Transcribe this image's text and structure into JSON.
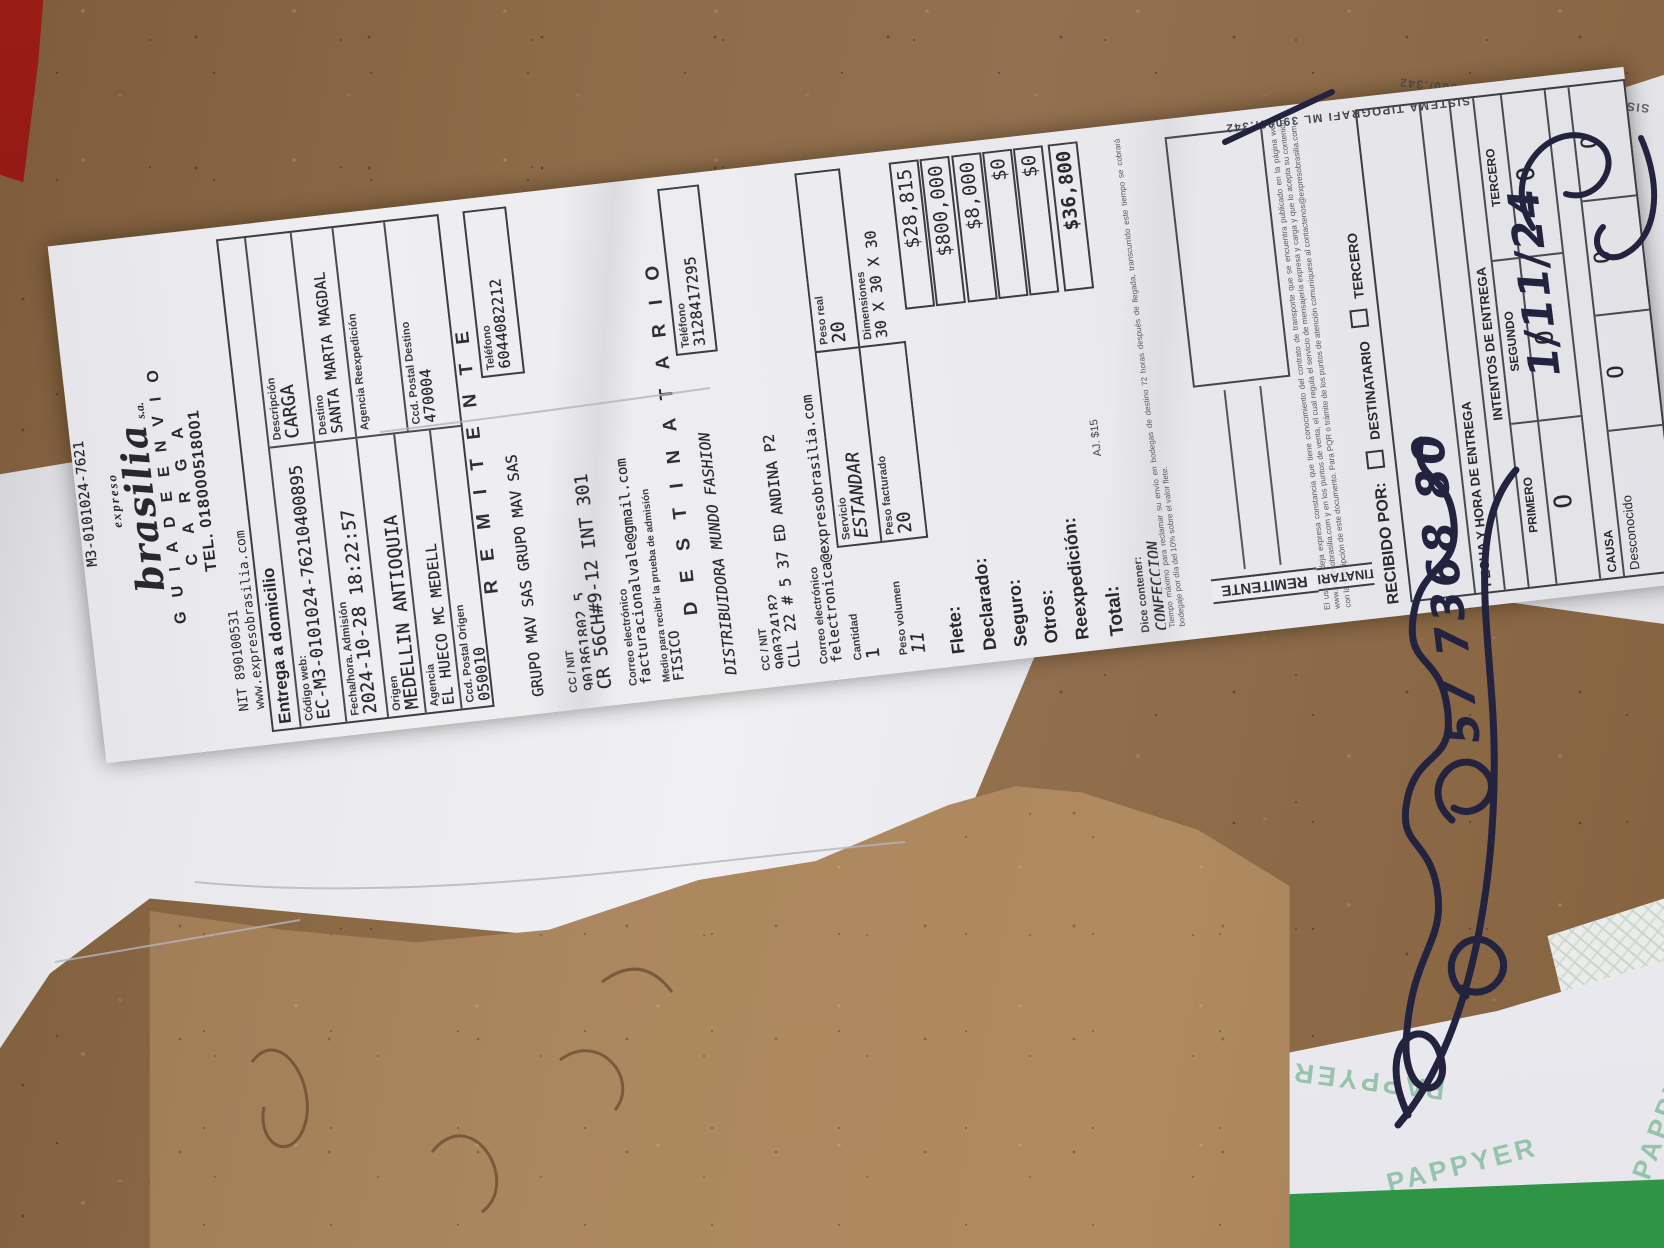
{
  "receipt": {
    "top_code": "M3-0101024-7621",
    "header": {
      "brand_top": "expreso",
      "brand_main": "brasilia",
      "brand_suffix": "s.a.",
      "title": "G U I A   D E   E N V I O",
      "subtitle": "C A R G A",
      "phone": "TEL. 018000518001",
      "nit": "NIT 890100531",
      "web": "www.expresobrasilia.com",
      "email": "contactenos@expresobrasilia.com",
      "resolution": "00159 del 30 de julio de 2.002"
    },
    "info": {
      "section_title": "Entrega a domicilio",
      "codigo_web_label": "Código web:",
      "codigo_web": "EC-M3-0101024-76210400895",
      "descripcion_label": "Descripción",
      "descripcion": "CARGA",
      "fecha_label": "Fecha/hora. Admisión",
      "fecha": "2024-10-28 18:22:57",
      "destino_label": "Destino",
      "destino": "SANTA MARTA MAGDAL",
      "origen_label": "Origen",
      "origen": "MEDELLIN ANTIOQUIA",
      "agencia_reexp_label": "Agencia Reexpedición",
      "agencia_label": "Agencia",
      "agencia": "EL HUECO MC MEDELL",
      "cp_destino_label": "Ccd. Postal Destino",
      "cp_destino": "470004",
      "cp_origen_label": "Ccd. Postal Origen",
      "cp_origen": "050010"
    },
    "remitente": {
      "title": "R E M I T E N T E",
      "nombre": "GRUPO MAV SAS GRUPO MAV SAS",
      "telefono_label": "Teléfono",
      "telefono": "6044082212",
      "ccnit_label": "CC / NIT",
      "ccnit": "901861802 5",
      "direccion": "CR 56CH#9-12 INT 301",
      "correo_label": "Correo electrónico",
      "correo": "facturacionalvale@gmail.com",
      "medio_label": "Medio para recibir la prueba de admisión",
      "medio": "FISICO"
    },
    "destinatario": {
      "title": "D E S T I N A T A R I O",
      "nombre": "DISTRIBUIDORA MUNDO FASHION",
      "telefono_label": "Teléfono",
      "telefono": "3128417295",
      "ccnit_label": "CC / NIT",
      "ccnit": "900324182",
      "direccion": "CLL 22 # 5 37 ED ANDINA P2",
      "correo_label": "Correo electrónico",
      "correo": "felectronica@expresobrasilia.com"
    },
    "cargo": {
      "cantidad_label": "Cantidad",
      "cantidad": "1",
      "servicio_label": "Servicio",
      "servicio": "ESTANDAR",
      "peso_real_label": "Peso real",
      "peso_real": "20",
      "peso_vol_label": "Peso volumen",
      "peso_vol": "11",
      "peso_fact_label": "Peso facturado",
      "peso_fact": "20",
      "dim_label": "Dimensiones",
      "dim": "30 X 30 X 30"
    },
    "totals": {
      "flete_label": "Flete:",
      "flete": "$28,815",
      "declarado_label": "Declarado:",
      "declarado": "$800,000",
      "seguro_label": "Seguro:",
      "seguro": "$8,000",
      "otros_label": "Otros:",
      "otros": "$0",
      "reexp_label": "Reexpedición:",
      "reexp": "$0",
      "total_label": "Total:",
      "total_note": "AJ. $15",
      "total": "$36,800",
      "dice_label": "Dice contener:",
      "dice": "CONFECCION"
    },
    "fine_print": {
      "p1": "Tiempo máximo para reclamar su envío en bodegas de destino 72 horas después de llegada, transcurrido este tiempo se cobrará bodegaje por día del 10% sobre el valor flete.",
      "p2": "El usuario deja expresa constancia que tiene conocimiento del contrato de transporte que se encuentra publicado en la página web www.expresobrasilia.com y en los puntos de venta, el cual regula el servicio de mensajería expresa y carga y que lo acepta su contenido con la suscripción de este documento. Para PQR o trámite de los puntos de atención comuníquese al contactenos@expresobrasilia.com"
    },
    "delivery": {
      "recibido_label": "RECIBIDO POR:",
      "opt_destinatario": "DESTINATARIO",
      "opt_tercero": "TERCERO",
      "fecha_label": "FECHA Y HORA DE ENTREGA",
      "intentos_label": "INTENTOS DE ENTREGA",
      "primero": "PRIMERO",
      "segundo": "SEGUNDO",
      "tercero": "TERCERO",
      "causa_label": "CAUSA",
      "desconocido": "Desconocido",
      "circle": "O"
    },
    "edge": {
      "remitente": "REMITENTE",
      "destinatario": "DESTINATARIO",
      "print_line": "SISTEMA TIPOGRAFI ML 39000/.342"
    }
  },
  "handwriting": {
    "date": "1/11/24",
    "number": "57 7368 80"
  },
  "background": {
    "pappyer_watermark": "PAPPYER",
    "back_receipt_fragment": "O",
    "colors": {
      "cardboard": "#8d6b47",
      "torn_cardboard": "#a7835e",
      "green_strip": "#3fa352",
      "pappyer_green": "#88bda0",
      "ink_blue": "#23233f",
      "red_patch": "#8a1511"
    }
  }
}
